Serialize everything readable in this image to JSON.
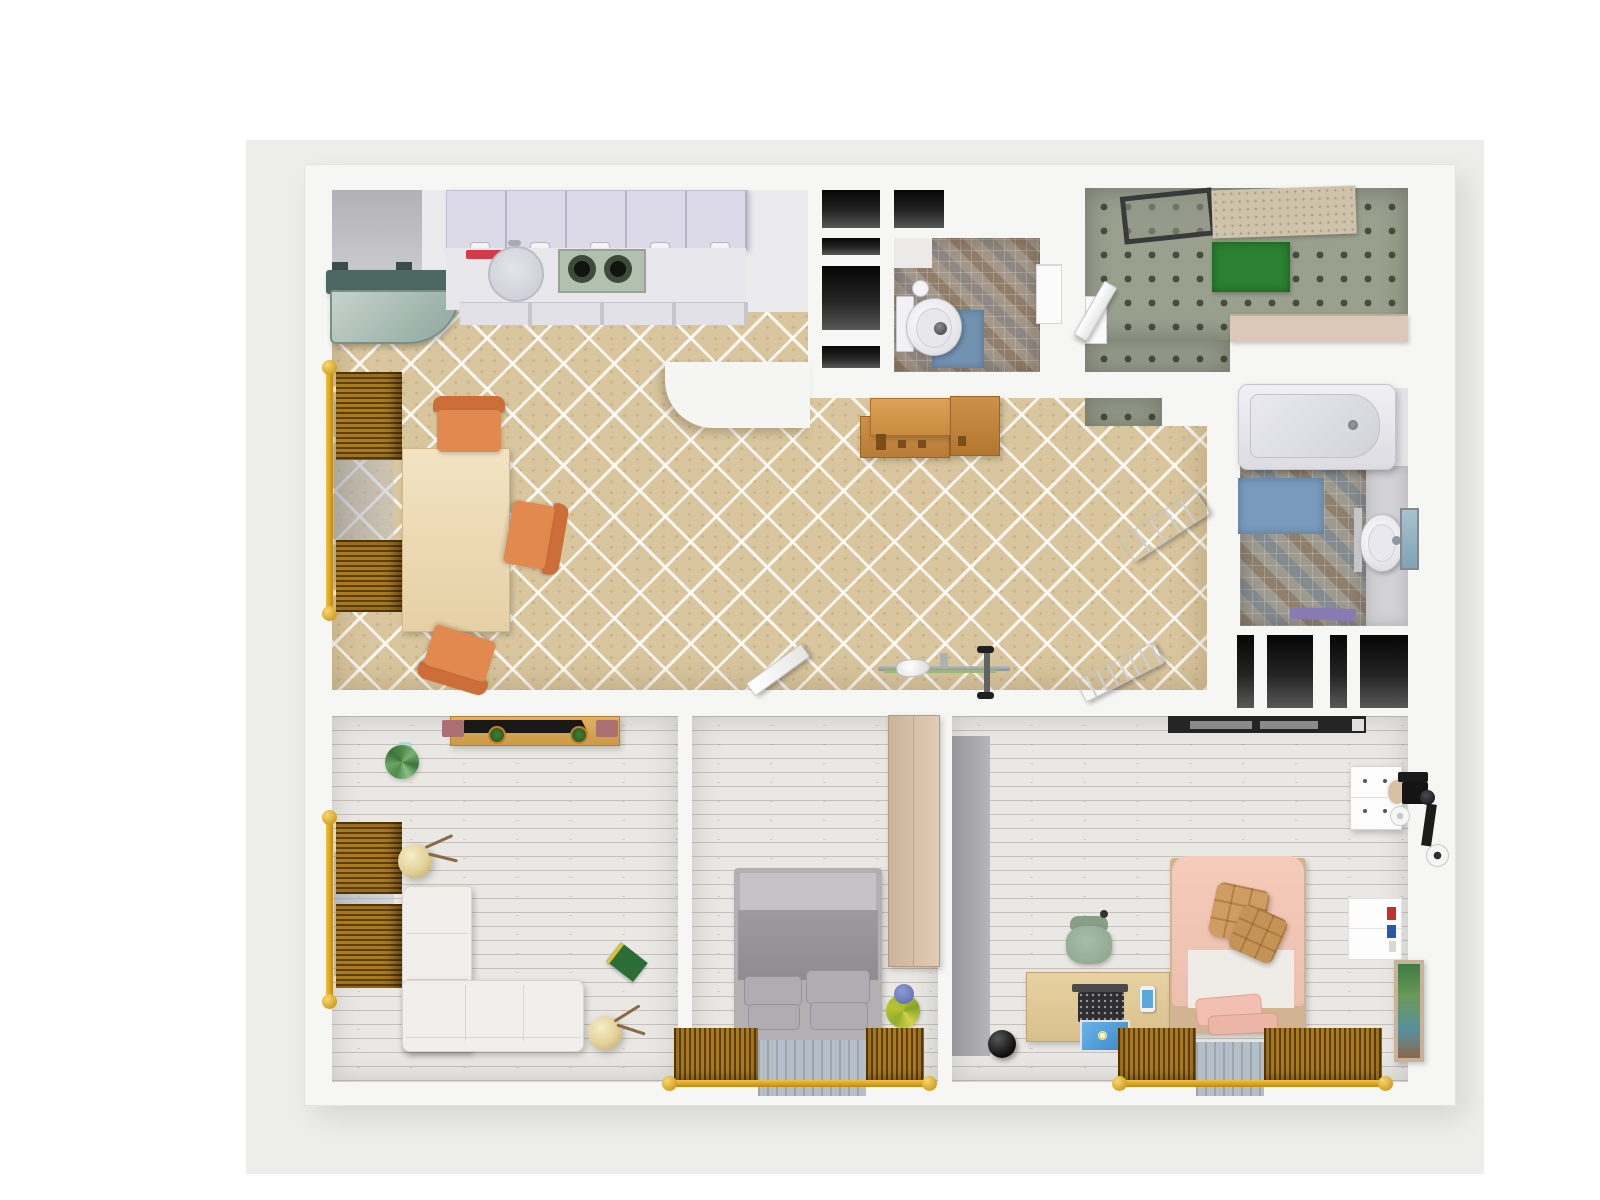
{
  "scene": {
    "type": "3d-floor-plan-render",
    "view": "top-down",
    "palette": {
      "page_background": "#ffffff",
      "render_canvas": "#ededec",
      "walls": "#f6f6f4",
      "beige_tile_floor": "#d9c69e",
      "plank_floor": "#e9e8e4",
      "mosaic_floor": "#a39789",
      "utility_dot_floor": "#9aa08e",
      "closet_dark": "#060606",
      "blind_wood": "#a97a1e",
      "curtain_rod_gold": "#d8a018",
      "accent_orange_chair": "#e28950",
      "accent_blue_mat": "#7292b2",
      "accent_green_mat": "#2c8232",
      "bed_gray": "#908c90",
      "bed_pink": "#f2c6b6",
      "wood_warm": "#c98c3f"
    },
    "rooms": [
      {
        "name": "kitchen-dining",
        "floor": "beige-diagonal-tile",
        "objects": [
          "wall-cabinets-5-doors",
          "counter-drawers",
          "round-sink",
          "red-tray",
          "gas-stove-2-burners",
          "fridge-glass-top",
          "dining-table",
          "orange-chair-top",
          "orange-chair-right",
          "orange-chair-bottom",
          "window-blinds-left",
          "rounded-partition"
        ]
      },
      {
        "name": "hallway",
        "floor": "beige-diagonal-tile",
        "objects": [
          "wooden-console",
          "exercise-bike",
          "open-door-living",
          "open-door-vestibule"
        ]
      },
      {
        "name": "entry-closets",
        "floor": "none",
        "objects": [
          "dark-closet-cell x5"
        ]
      },
      {
        "name": "wc",
        "floor": "mosaic-tile",
        "objects": [
          "toilet",
          "blue-mat",
          "toilet-paper-roll",
          "wall-shelf"
        ]
      },
      {
        "name": "utility-room",
        "floor": "gray-dotted-tile",
        "objects": [
          "ceiling-drying-rack",
          "tan-mat",
          "green-mat",
          "tan-counter",
          "open-door",
          "white-cabinet"
        ]
      },
      {
        "name": "bathroom",
        "floor": "mosaic-blue-tile",
        "objects": [
          "bathtub",
          "blue-bath-mat",
          "pedestal-sink",
          "mirror",
          "purple-towel",
          "open-paneled-door",
          "dark-closet-cell x4"
        ]
      },
      {
        "name": "living-room",
        "floor": "white-plank",
        "objects": [
          "tv-stand",
          "tv-soundbar",
          "pink-bookends",
          "mini-plants",
          "corner-plant",
          "l-shaped-white-sofa",
          "paper-lantern-lamp x2",
          "green-book",
          "window-blinds-left"
        ]
      },
      {
        "name": "bedroom-1",
        "floor": "white-plank",
        "objects": [
          "double-bed-gray",
          "wardrobe-tall",
          "vase-with-flowers",
          "window-blinds-bottom",
          "gray-rug"
        ]
      },
      {
        "name": "bedroom-2",
        "floor": "white-plank",
        "objects": [
          "coat-rail-black",
          "desk-wood",
          "typewriter-laptop",
          "blue-screen",
          "phone",
          "green-chair",
          "single-bed-pink",
          "tan-cushions x2",
          "white-drawer-unit",
          "oval-mirror",
          "camera-tripod-gear",
          "paper-roll",
          "wall-shelf-books",
          "picture-frame",
          "black-ball",
          "window-blinds-bottom",
          "gray-rug"
        ]
      }
    ]
  }
}
